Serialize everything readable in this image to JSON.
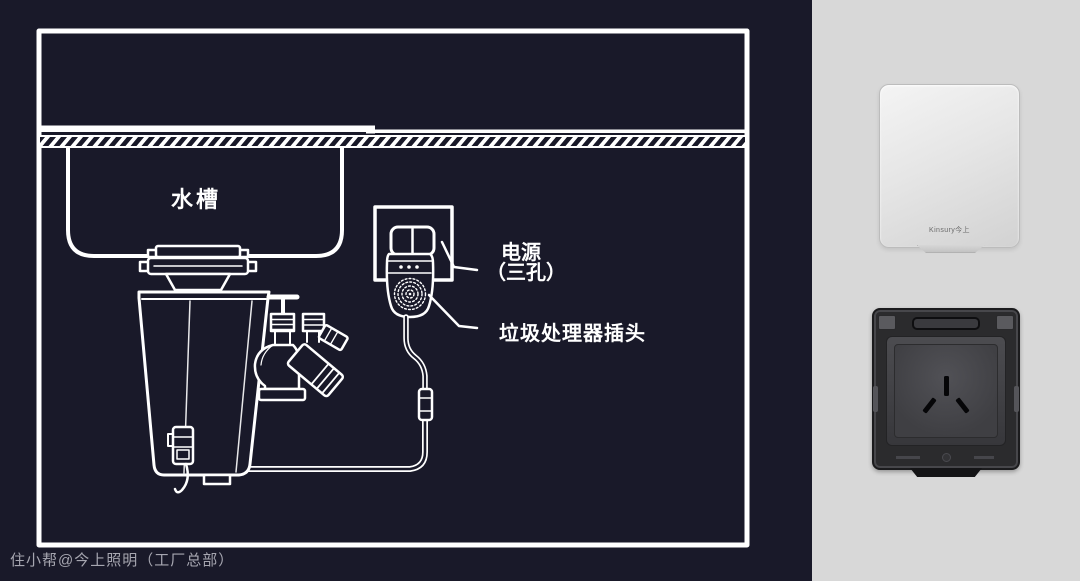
{
  "diagram": {
    "sink_label": "水槽",
    "power_label": {
      "line1": "电源",
      "line2": "（三孔）"
    },
    "plug_label": "垃圾处理器插头"
  },
  "watermark": "住小帮@今上照明（工厂总部）",
  "products": {
    "splash_cover": {
      "logo": "Kinsury今上"
    }
  },
  "colors": {
    "background_dark": "#191929",
    "line_white": "#ffffff",
    "panel_gray": "#d8d8d8",
    "socket_body": "#2b2b2d"
  }
}
